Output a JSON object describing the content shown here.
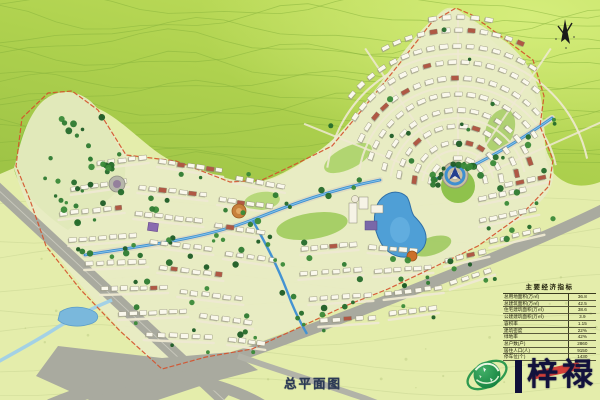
{
  "plan": {
    "title": "总平面图"
  },
  "indicators": {
    "title": "主要经济指标",
    "rows": [
      {
        "label": "总用地面积(万㎡)",
        "value": "36.8"
      },
      {
        "label": "总建筑面积(万㎡)",
        "value": "42.5"
      },
      {
        "label": "住宅建筑面积(万㎡)",
        "value": "38.6"
      },
      {
        "label": "公建建筑面积(万㎡)",
        "value": "3.9"
      },
      {
        "label": "容积率",
        "value": "1.15"
      },
      {
        "label": "建筑密度",
        "value": "22%"
      },
      {
        "label": "绿地率",
        "value": "42%"
      },
      {
        "label": "总户数(户)",
        "value": "2860"
      },
      {
        "label": "居住人口(人)",
        "value": "9150"
      },
      {
        "label": "停车位(个)",
        "value": "1430"
      }
    ]
  },
  "logo": {
    "divider": "|",
    "name": "梓禄"
  },
  "icons": {
    "north_arrow": "compass-north",
    "globe": "green-globe-leaf-logo"
  },
  "colors": {
    "hill_green": "#aacd4f",
    "hill_light": "#d4ec79",
    "land_pale": "#e4edab",
    "road_gray": "#a9aa9f",
    "street_tan": "#eee9d2",
    "water_blue": "#3f8fd0",
    "lake_blue": "#4f9fd6",
    "boundary_red": "#d4502a",
    "tree_green": "#2e7b31",
    "building_white": "#faf8ec",
    "roof_red": "#b05844",
    "logo_green": "#1e8c46",
    "brand_navy": "#12123c",
    "accent_red": "#d02c2c"
  }
}
